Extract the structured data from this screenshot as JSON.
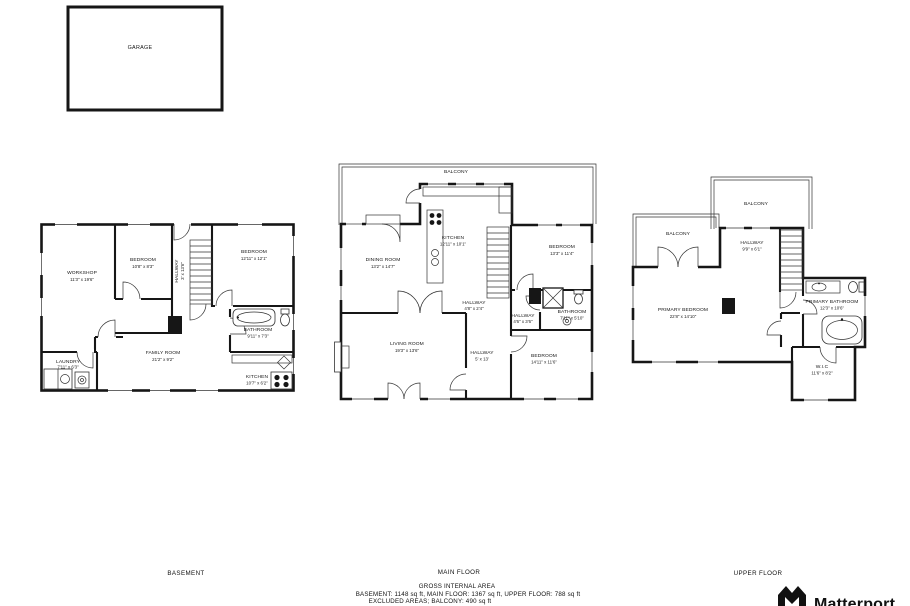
{
  "garage": {
    "label": "GARAGE"
  },
  "floors": {
    "basement": {
      "label": "BASEMENT",
      "rooms": {
        "workshop": {
          "name": "WORKSHOP",
          "dims": "11'3\" x 19'6\""
        },
        "bedroom1": {
          "name": "BEDROOM",
          "dims": "10'8\" x 8'3\""
        },
        "hallway": {
          "name": "HALLWAY",
          "dims": "3' x 13'6\""
        },
        "bedroom2": {
          "name": "BEDROOM",
          "dims": "12'11\" x 12'1\""
        },
        "bathroom": {
          "name": "BATHROOM",
          "dims": "9'11\" x 7'3\""
        },
        "family_room": {
          "name": "FAMILY ROOM",
          "dims": "21'2\" x 9'2\""
        },
        "laundry": {
          "name": "LAUNDRY",
          "dims": "7'11\" x 6'3\""
        },
        "kitchen": {
          "name": "KITCHEN",
          "dims": "10'7\" x 6'2\""
        }
      }
    },
    "main": {
      "label": "MAIN FLOOR",
      "rooms": {
        "balcony": {
          "name": "BALCONY"
        },
        "dining": {
          "name": "DINING ROOM",
          "dims": "13'2\" x 14'7\""
        },
        "kitchen": {
          "name": "KITCHEN",
          "dims": "12'11\" x 10'1\""
        },
        "bedroom1": {
          "name": "BEDROOM",
          "dims": "13'3\" x 11'4\""
        },
        "hallway1": {
          "name": "HALLWAY",
          "dims": "4'8\" x 2'4\""
        },
        "hallway2": {
          "name": "HALLWAY",
          "dims": "4'6\" x 3'6\""
        },
        "bathroom": {
          "name": "BATHROOM",
          "dims": "7'11\" x 5'10\""
        },
        "living": {
          "name": "LIVING ROOM",
          "dims": "19'3\" x 13'6\""
        },
        "hallway3": {
          "name": "HALLWAY",
          "dims": "5' x 13'"
        },
        "bedroom2": {
          "name": "BEDROOM",
          "dims": "14'11\" x 11'6\""
        }
      }
    },
    "upper": {
      "label": "UPPER FLOOR",
      "rooms": {
        "balcony_top": {
          "name": "BALCONY"
        },
        "balcony_left": {
          "name": "BALCONY"
        },
        "hallway": {
          "name": "HALLWAY",
          "dims": "9'9\" x 6'1\""
        },
        "primary_bedroom": {
          "name": "PRIMARY BEDROOM",
          "dims": "22'8\" x 14'10\""
        },
        "primary_bathroom": {
          "name": "PRIMARY BATHROOM",
          "dims": "12'3\" x 10'6\""
        },
        "wic": {
          "name": "W.I.C",
          "dims": "11'6\" x 8'2\""
        }
      }
    }
  },
  "footer": {
    "gross_title": "GROSS INTERNAL AREA",
    "areas_line": "BASEMENT: 1148 sq ft, MAIN FLOOR: 1367 sq ft, UPPER FLOOR: 788 sq ft",
    "excluded_line": "EXCLUDED AREAS;  BALCONY: 490 sq ft"
  },
  "logo": {
    "brand": "Matterport"
  }
}
